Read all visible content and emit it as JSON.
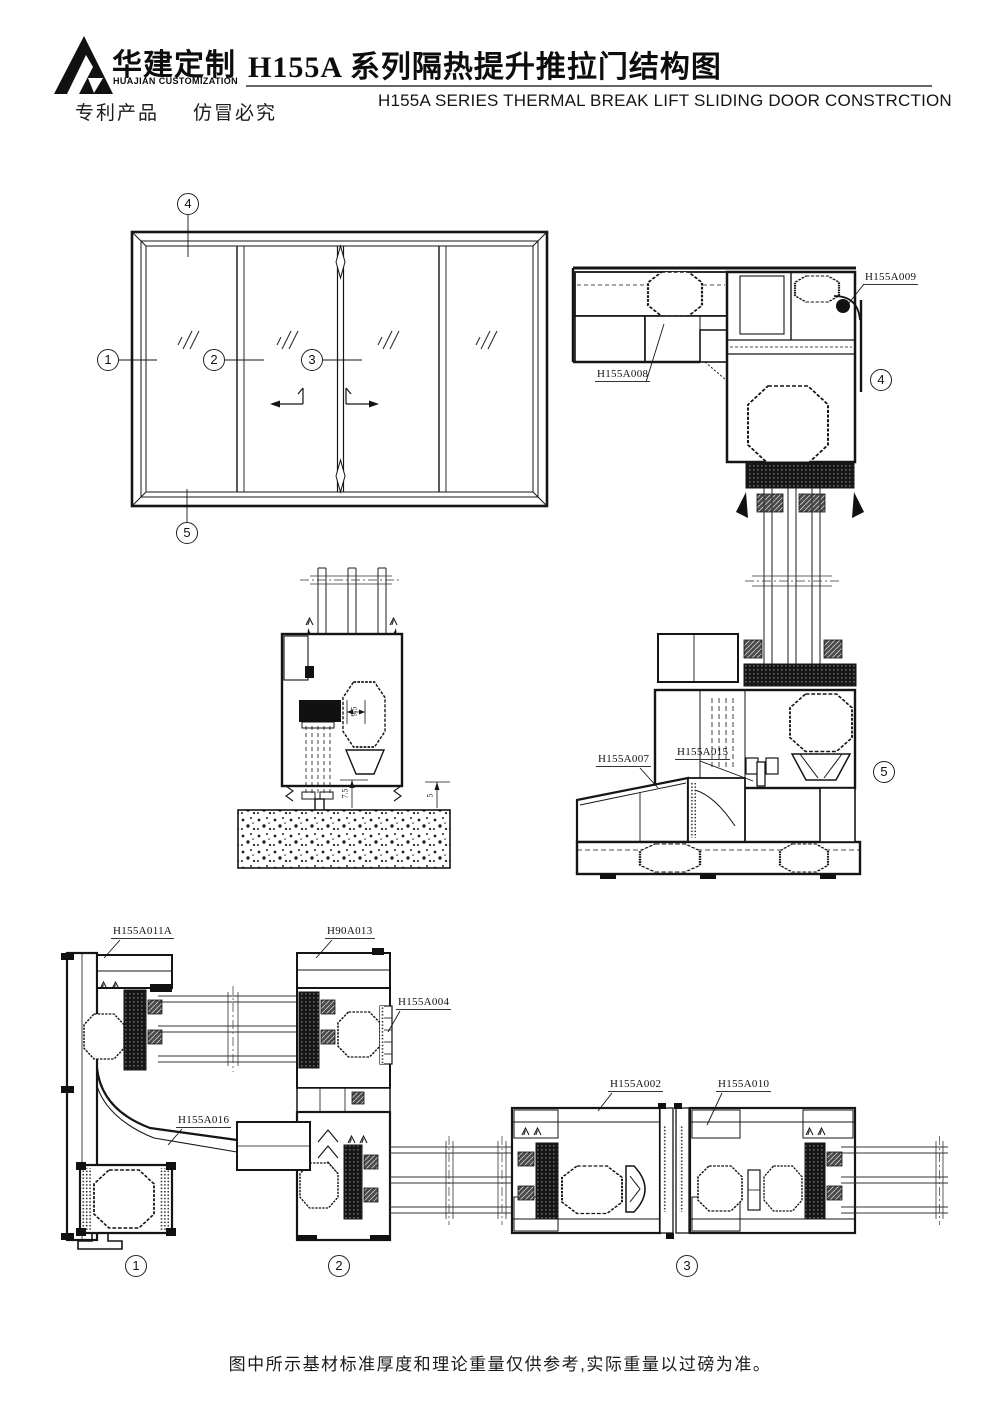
{
  "header": {
    "logo_cn": "华建定制",
    "logo_en": "HUAJIAN CUSTOMIZATION",
    "patent_left": "专利产品",
    "patent_right": "仿冒必究",
    "title_cn": "H155A 系列隔热提升推拉门结构图",
    "title_en": "H155A SERIES THERMAL BREAK LIFT SLIDING DOOR CONSTRCTION"
  },
  "callouts": {
    "n1": "1",
    "n2": "2",
    "n3": "3",
    "n4": "4",
    "n5": "5"
  },
  "part_labels": {
    "h155a009": "H155A009",
    "h155a008": "H155A008",
    "h155a007": "H155A007",
    "h155a015": "H155A015",
    "h155a011a": "H155A011A",
    "h90a013": "H90A013",
    "h155a004": "H155A004",
    "h155a016": "H155A016",
    "h155a002": "H155A002",
    "h155a010": "H155A010"
  },
  "dimensions": {
    "d95": "9.5",
    "d75": "7.5",
    "d5": "5"
  },
  "footer": {
    "note": "图中所示基材标准厚度和理论重量仅供参考,实际重量以过磅为准。"
  },
  "colors": {
    "ink": "#151515",
    "paper": "#ffffff"
  }
}
